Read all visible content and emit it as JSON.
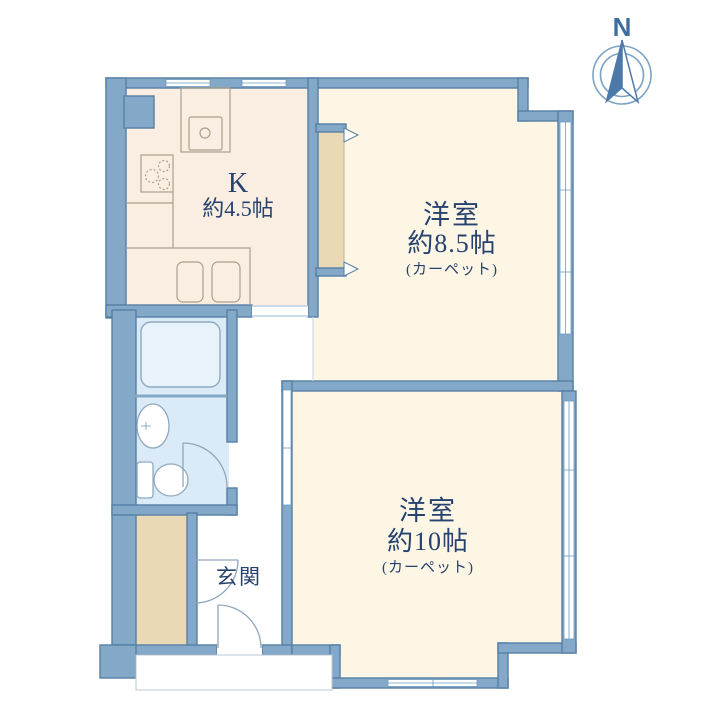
{
  "floorplan": {
    "compass": {
      "label": "N"
    },
    "rooms": {
      "kitchen": {
        "name": "K",
        "size": "約4.5帖"
      },
      "western_room_1": {
        "name": "洋室",
        "size": "約8.5帖",
        "note": "(カーペット)"
      },
      "western_room_2": {
        "name": "洋室",
        "size": "約10帖",
        "note": "(カーペット)"
      },
      "entrance": {
        "name": "玄関"
      }
    },
    "colors": {
      "wall": "#84a8c8",
      "wall_outline": "#567fa6",
      "room_floor": "#fdf6e5",
      "kitchen_floor": "#faeee3",
      "closet": "#e9d9b5",
      "bath_floor": "#daeaf6",
      "label_text": "#27426f"
    }
  }
}
